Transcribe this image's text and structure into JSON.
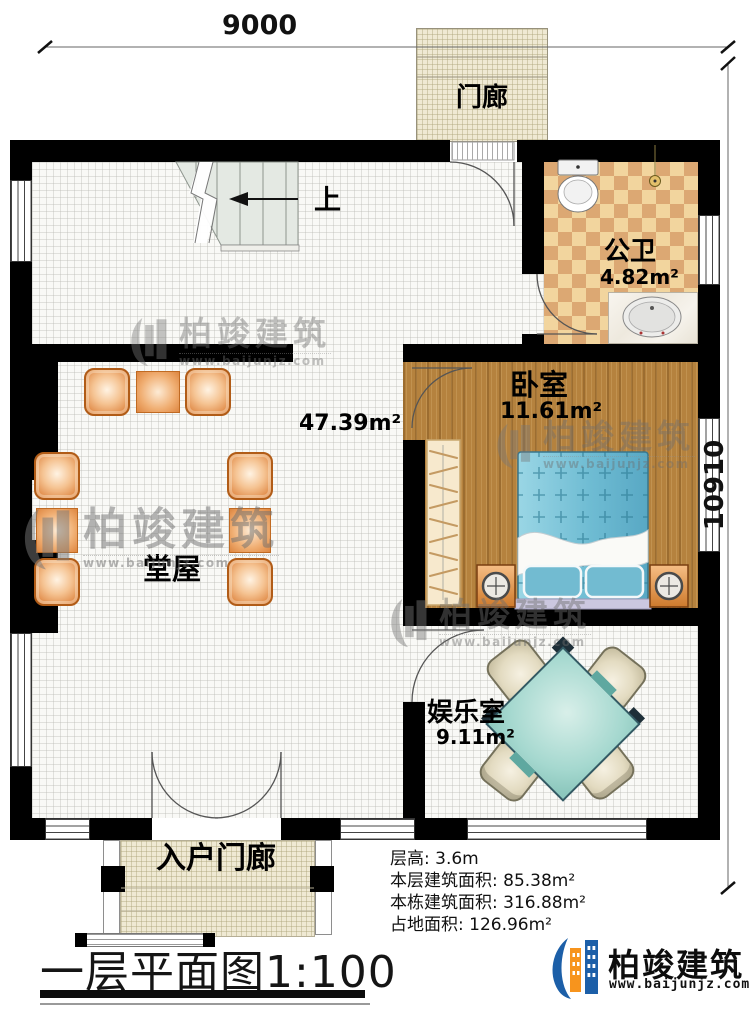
{
  "scale_labels": {
    "top_width": "9000",
    "right_height": "10910"
  },
  "rooms": {
    "porch": {
      "name": "门廊"
    },
    "bathroom": {
      "name": "公卫",
      "area": "4.82m²"
    },
    "bedroom": {
      "name": "卧室",
      "area": "11.61m²"
    },
    "hall": {
      "name": "堂屋",
      "area": "47.39m²"
    },
    "entertainment": {
      "name": "娱乐室",
      "area": "9.11m²"
    },
    "entrance_porch": {
      "name": "入户门廊"
    }
  },
  "stairs": {
    "up_label": "上"
  },
  "info": {
    "line1": "层高: 3.6m",
    "line2": "本层建筑面积: 85.38m²",
    "line3": "本栋建筑面积: 316.88m²",
    "line4": "占地面积: 126.96m²"
  },
  "title": "一层平面图1:100",
  "brand": {
    "name": "柏竣建筑",
    "url": "www.baijunjz.com"
  },
  "watermark": {
    "name": "柏竣建筑",
    "url": "www.baijunjz.com"
  },
  "colors": {
    "wall": "#000000",
    "wood_floor": "#B5823E",
    "tile_light": "#F2D59E",
    "tile_dark": "#DCA873",
    "bed_blue": "#6FBCD3",
    "mahjong_table": "#A5D8CF",
    "brand_blue": "#1C5FA8",
    "brand_orange": "#F7941D"
  }
}
